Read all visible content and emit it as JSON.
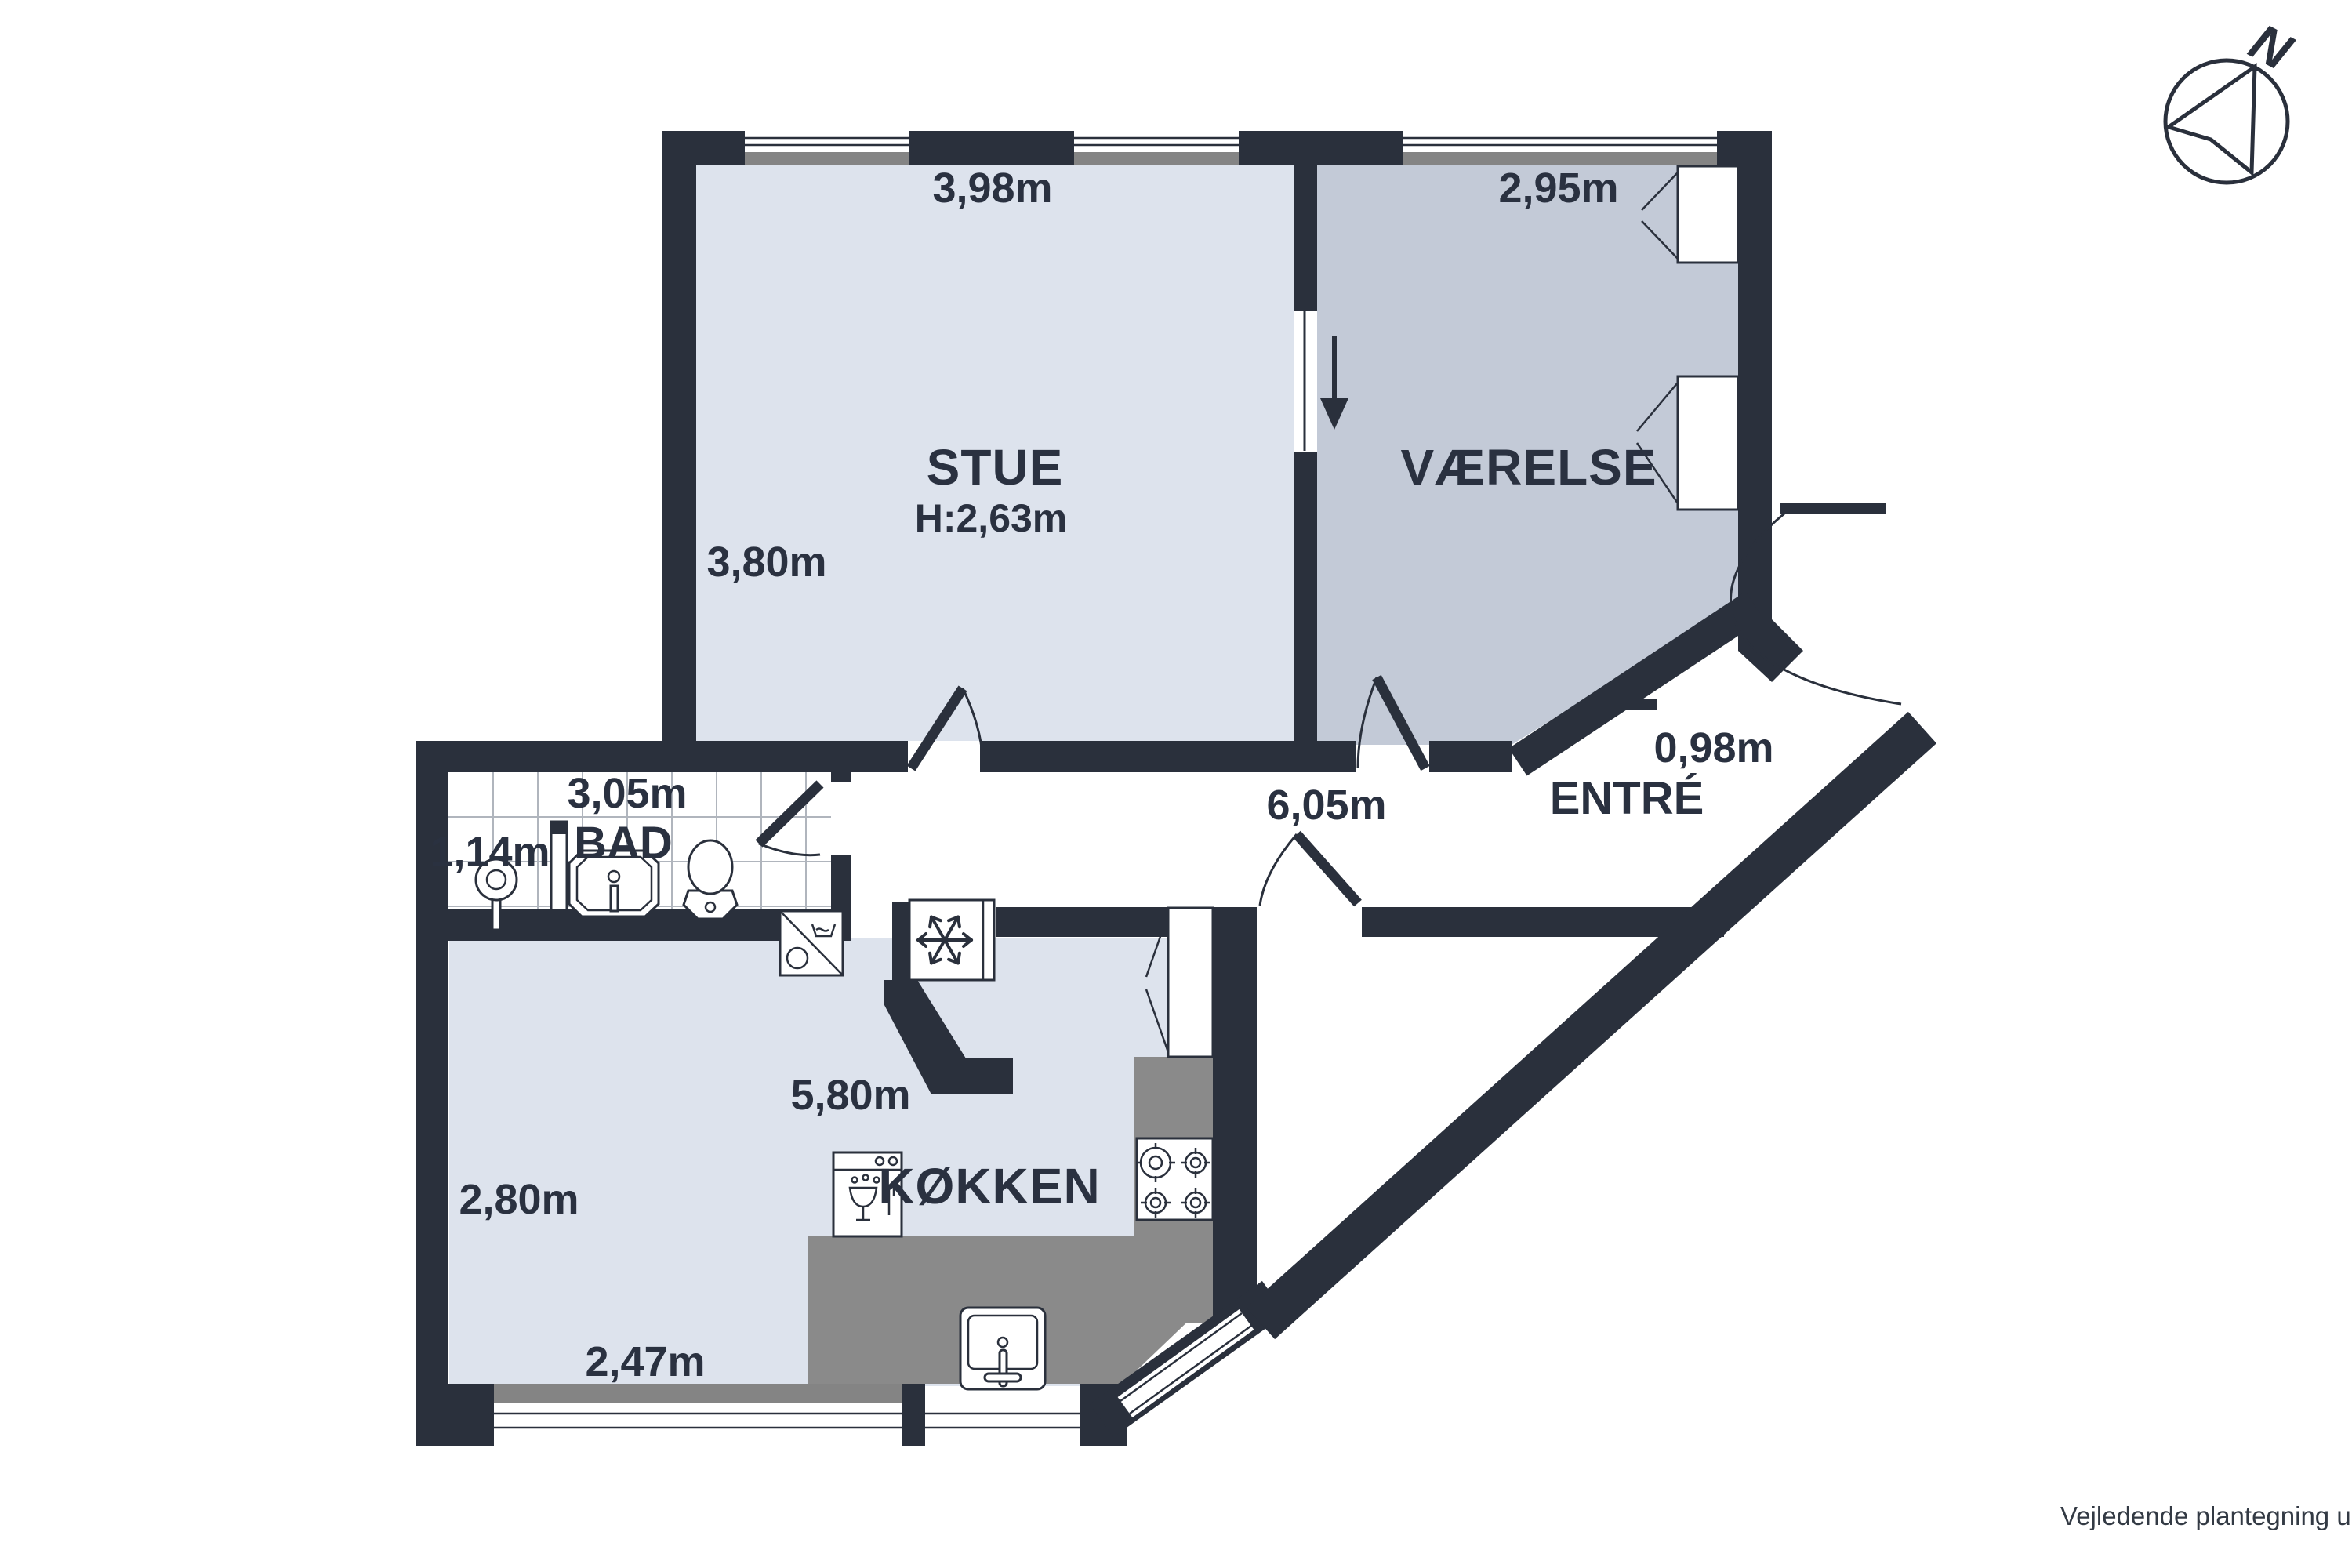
{
  "page": {
    "disclaimer": "Vejledende plantegning uden ansvar"
  },
  "compass": {
    "north_label": "N"
  },
  "rooms": {
    "stue": {
      "name": "STUE",
      "ceiling_height": "H:2,63m",
      "width": "3,98m",
      "depth": "3,80m"
    },
    "vaerelse": {
      "name": "VÆRELSE",
      "width": "2,95m"
    },
    "bad": {
      "name": "BAD",
      "width": "3,05m",
      "depth": "1,14m"
    },
    "koekken": {
      "name": "KØKKEN",
      "width": "5,80m",
      "depth": "2,80m",
      "window_width": "2,47m"
    },
    "entre": {
      "name": "ENTRÉ",
      "door_width": "0,98m"
    },
    "gang": {
      "length": "6,05m"
    }
  },
  "colors": {
    "wall": "#2a303c",
    "room_light": "#dde3ed",
    "room_dark": "#c3cad7",
    "counter": "#8a8a8a",
    "window_sill": "#848484",
    "text": "#2a3140"
  },
  "icons": [
    "compass-north-icon",
    "shower-icon",
    "bathroom-sink-icon",
    "toilet-icon",
    "washing-machine-icon",
    "freezer-snowflake-icon",
    "dishwasher-icon",
    "stove-hob-icon",
    "kitchen-sink-icon",
    "wardrobe-icon",
    "door-swing-icon",
    "direction-arrow-icon"
  ]
}
